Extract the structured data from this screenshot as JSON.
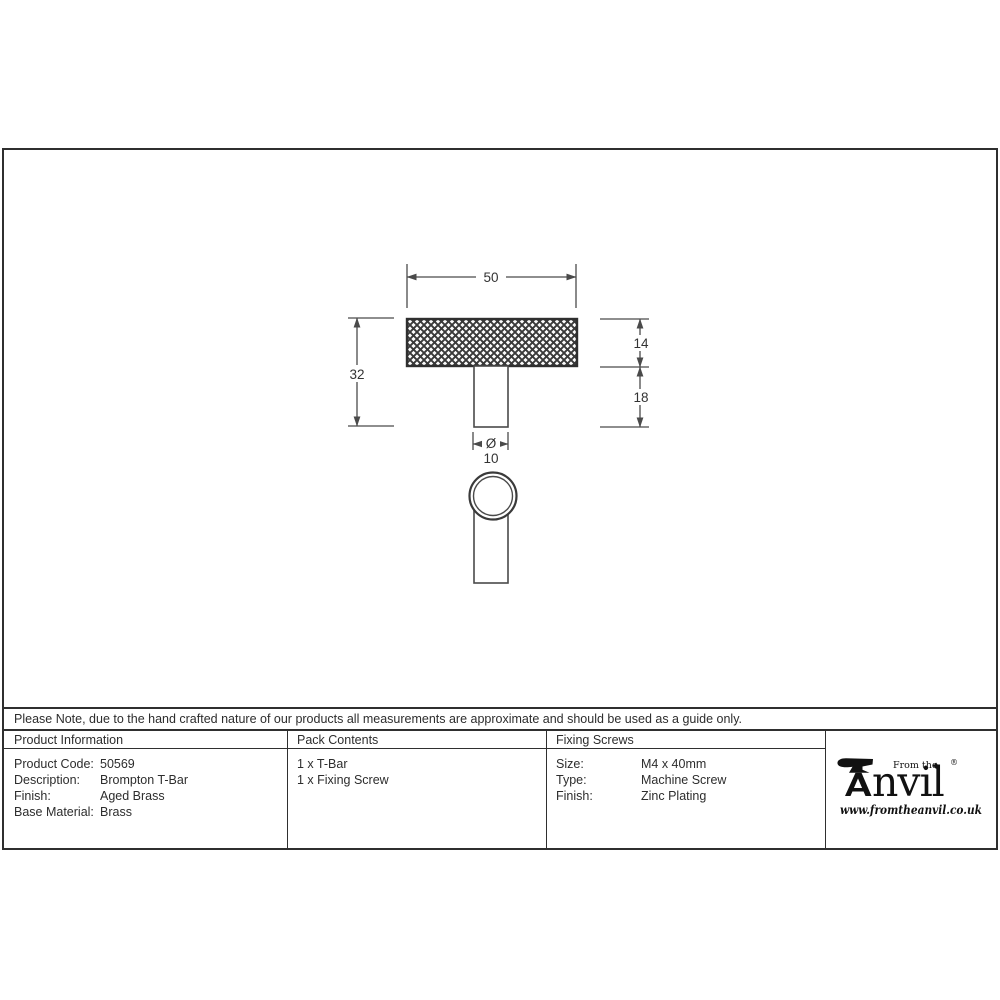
{
  "drawing": {
    "dim_width": "50",
    "dim_total_height": "32",
    "dim_bar_height": "14",
    "dim_stem_height": "18",
    "dim_diameter_symbol": "Ø",
    "dim_diameter": "10"
  },
  "note": {
    "text": "Please Note, due to the hand crafted nature of our products all measurements are approximate and should be used as a guide only."
  },
  "table": {
    "product_info": {
      "header": "Product Information",
      "rows": [
        {
          "label": "Product Code:",
          "value": "50569"
        },
        {
          "label": "Description:",
          "value": "Brompton T-Bar"
        },
        {
          "label": "Finish:",
          "value": "Aged Brass"
        },
        {
          "label": "Base Material:",
          "value": "Brass"
        }
      ]
    },
    "pack_contents": {
      "header": "Pack Contents",
      "items": [
        "1 x T-Bar",
        "1 x Fixing Screw"
      ]
    },
    "fixing_screws": {
      "header": "Fixing Screws",
      "rows": [
        {
          "label": "Size:",
          "value": "M4 x 40mm"
        },
        {
          "label": "Type:",
          "value": "Machine Screw"
        },
        {
          "label": "Finish:",
          "value": "Zinc Plating"
        }
      ]
    }
  },
  "logo": {
    "from_the": "From the",
    "diamond": "♦",
    "brand_suffix": "nvil",
    "registered": "®",
    "url": "www.fromtheanvil.co.uk"
  },
  "colors": {
    "ink": "#2f2f2f",
    "drawing_line": "#4a4a4a",
    "background": "#ffffff"
  }
}
